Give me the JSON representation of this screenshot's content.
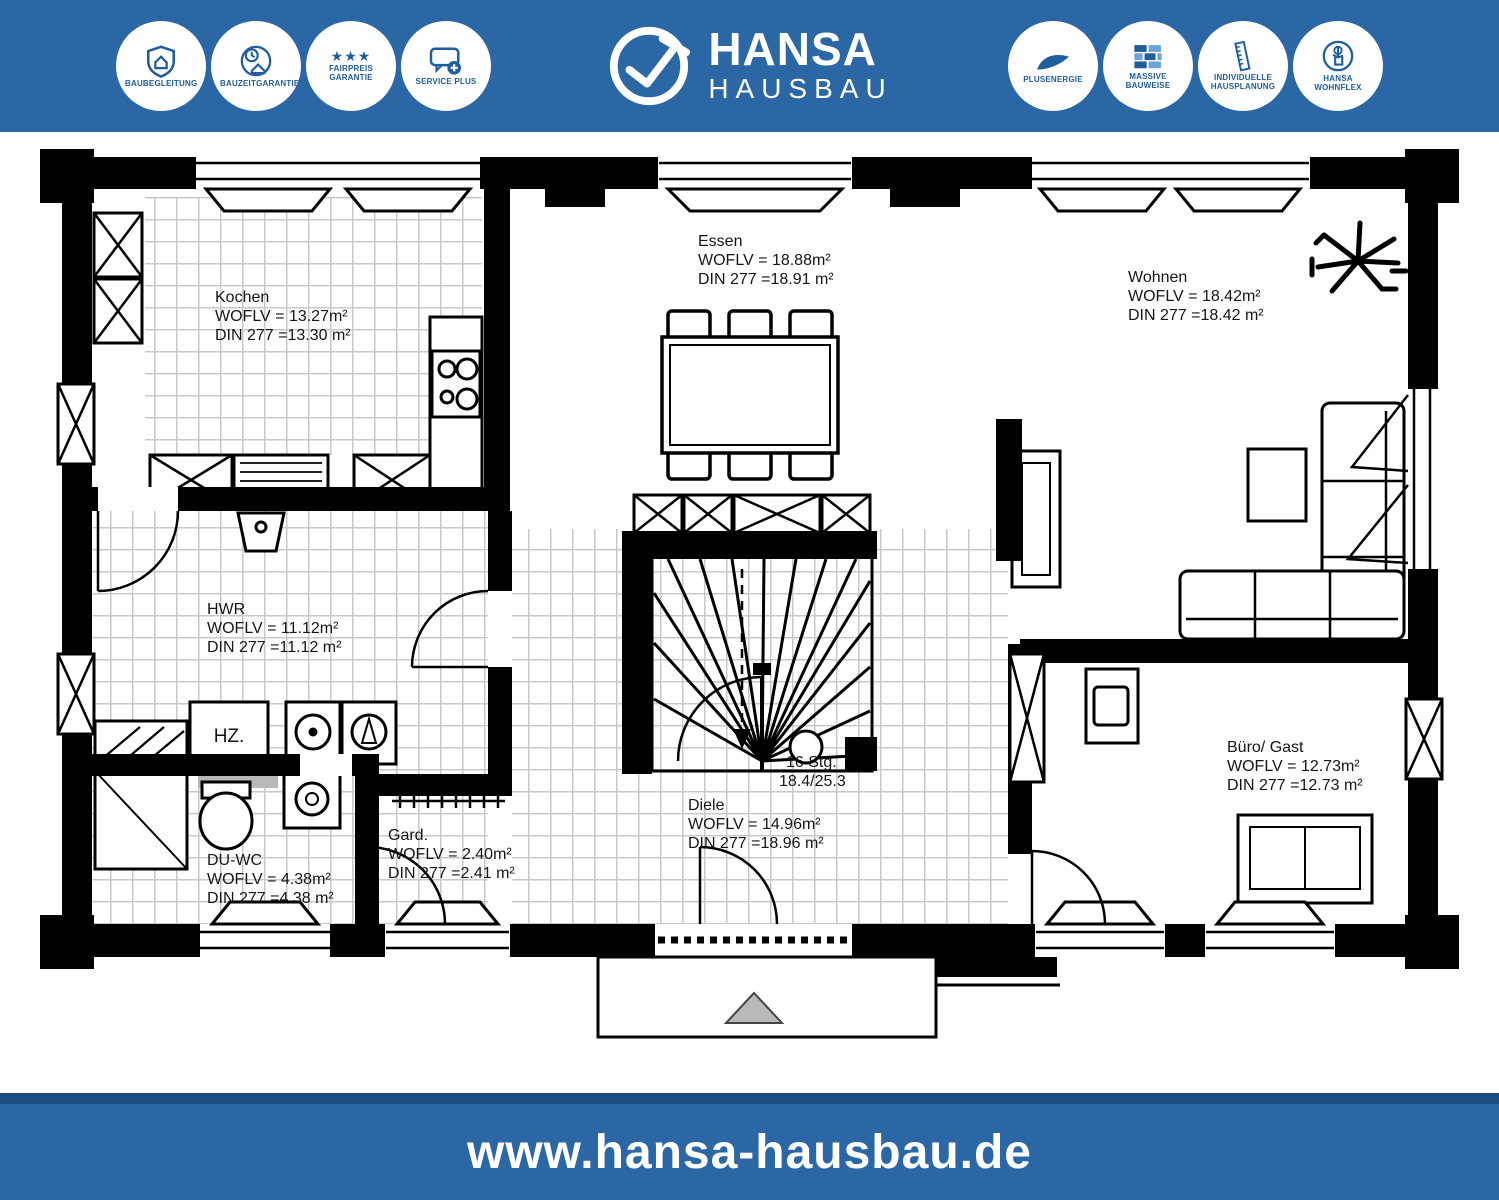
{
  "header": {
    "badges_left": [
      {
        "label": "BAUBEGLEITUNG",
        "icon": "shield-house-icon"
      },
      {
        "label": "BAUZEITGARANTIE",
        "icon": "clock-house-icon"
      },
      {
        "label": "FAIRPREIS GARANTIE",
        "icon": "star-seal-icon"
      },
      {
        "label": "SERVICE PLUS",
        "icon": "speech-bubble-plus-icon"
      }
    ],
    "logo": {
      "title": "HANSA",
      "subtitle": "HAUSBAU",
      "icon": "circle-check-logo-icon"
    },
    "badges_right": [
      {
        "label": "PLUSENERGIE",
        "icon": "energy-swoosh-icon"
      },
      {
        "label": "MASSIVE BAUWEISE",
        "icon": "brick-wall-icon"
      },
      {
        "label": "INDIVIDUELLE HAUSPLANUNG",
        "icon": "ruler-icon"
      },
      {
        "label": "HANSA WOHNFLEX",
        "icon": "hand-click-icon"
      }
    ],
    "stars": "★★★"
  },
  "plan": {
    "rooms": {
      "kochen": {
        "name": "Kochen",
        "woflv": "WOFLV = 13.27m²",
        "din": "DIN 277 =13.30 m²"
      },
      "essen": {
        "name": "Essen",
        "woflv": "WOFLV = 18.88m²",
        "din": "DIN 277 =18.91 m²"
      },
      "wohnen": {
        "name": "Wohnen",
        "woflv": "WOFLV = 18.42m²",
        "din": "DIN 277 =18.42 m²"
      },
      "hwr": {
        "name": "HWR",
        "woflv": "WOFLV = 11.12m²",
        "din": "DIN 277 =11.12 m²"
      },
      "duwc": {
        "name": "DU-WC",
        "woflv": "WOFLV = 4.38m²",
        "din": "DIN 277 =4.38 m²"
      },
      "gard": {
        "name": "Gard.",
        "woflv": "WOFLV = 2.40m²",
        "din": "DIN 277 =2.41 m²"
      },
      "diele": {
        "name": "Diele",
        "woflv": "WOFLV = 14.96m²",
        "din": "DIN 277 =18.96 m²"
      },
      "buero": {
        "name": "Büro/ Gast",
        "woflv": "WOFLV = 12.73m²",
        "din": "DIN 277 =12.73 m²"
      }
    },
    "stairs": {
      "steps": "16 Stg.",
      "dims": "18.4/25.3"
    },
    "heating_label": "HZ."
  },
  "footer": {
    "url": "www.hansa-hausbau.de"
  },
  "colors": {
    "brand_blue": "#2b67a4",
    "footer_dark": "#1b4e7f",
    "badge_blue": "#1e5d9e",
    "brick_light": "#6ba4d9",
    "hatch_gray": "#c8c8c8",
    "triangle_gray": "#b9b9b9"
  }
}
